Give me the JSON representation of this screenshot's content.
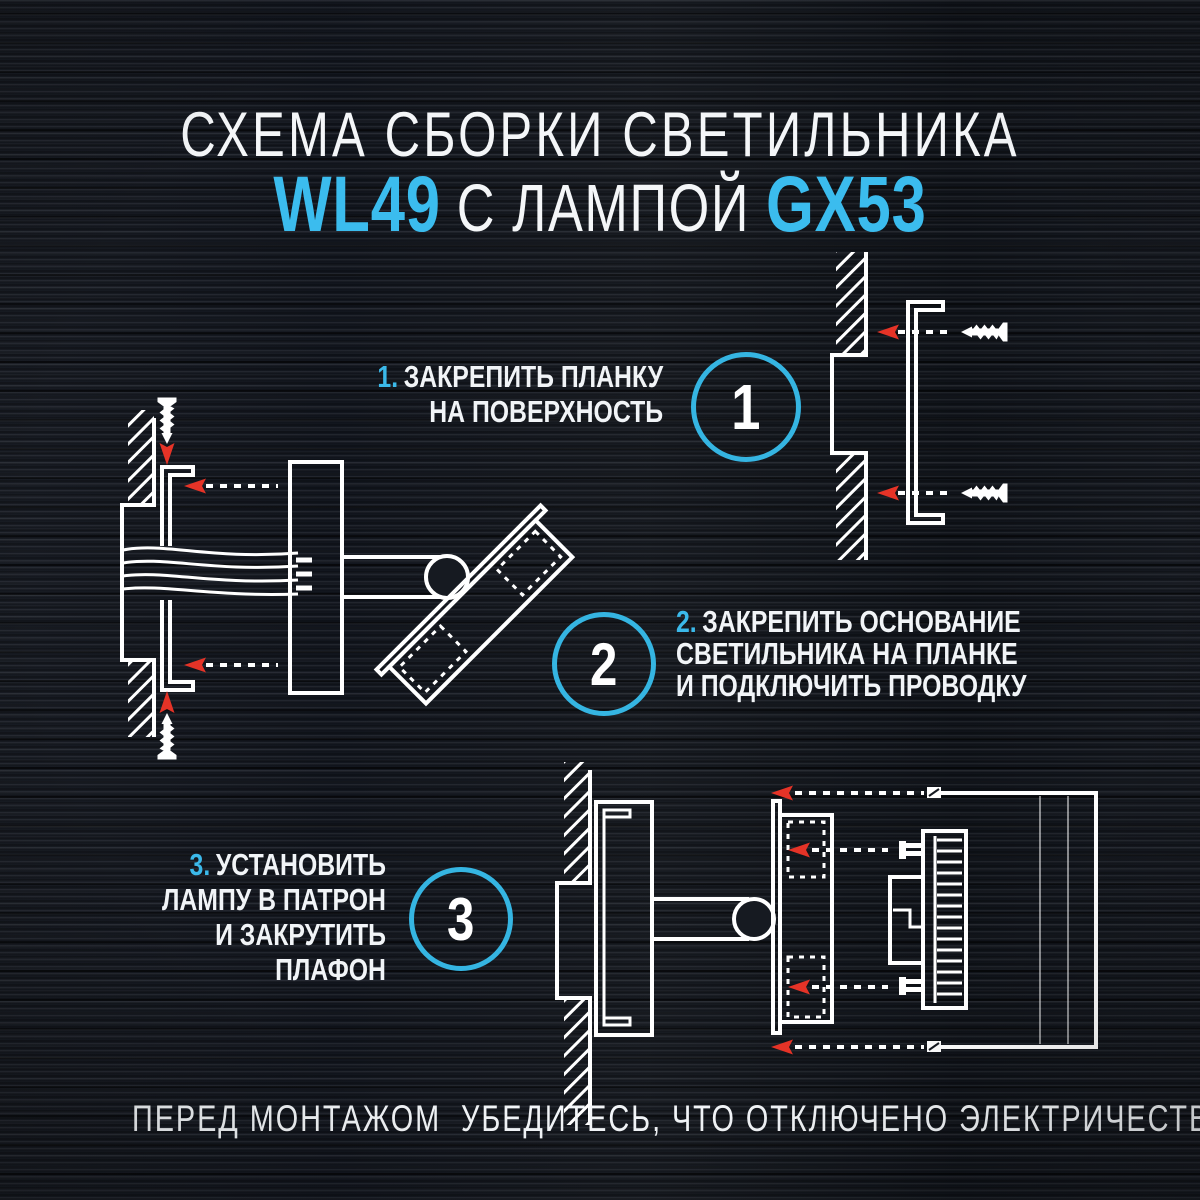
{
  "title": {
    "line1": "СХЕМА СБОРКИ СВЕТИЛЬНИКА",
    "model": "WL49",
    "middle": "С ЛАМПОЙ",
    "lamp": "GX53"
  },
  "steps": [
    {
      "badge": "1",
      "prefix": "1.",
      "lines": [
        "ЗАКРЕПИТЬ ПЛАНКУ",
        "НА ПОВЕРХНОСТЬ"
      ]
    },
    {
      "badge": "2",
      "prefix": "2.",
      "lines": [
        "ЗАКРЕПИТЬ ОСНОВАНИЕ",
        "СВЕТИЛЬНИКА НА ПЛАНКЕ",
        "И ПОДКЛЮЧИТЬ ПРОВОДКУ"
      ]
    },
    {
      "badge": "3",
      "prefix": "3.",
      "lines": [
        "УСТАНОВИТЬ",
        "ЛАМПУ В ПАТРОН",
        "И ЗАКРУТИТЬ",
        "ПЛАФОН"
      ]
    }
  ],
  "footer": {
    "warning": "ПЕРЕД МОНТАЖОМ  УБЕДИТЕСЬ, ЧТО ОТКЛЮЧЕНО ЭЛЕКТРИЧЕСТВО!"
  },
  "colors": {
    "background": "#161a21",
    "accent_cyan": "#3bb9ea",
    "text_white": "#f2f5f8",
    "line_white": "#ffffff",
    "arrow_red": "#e53327"
  }
}
